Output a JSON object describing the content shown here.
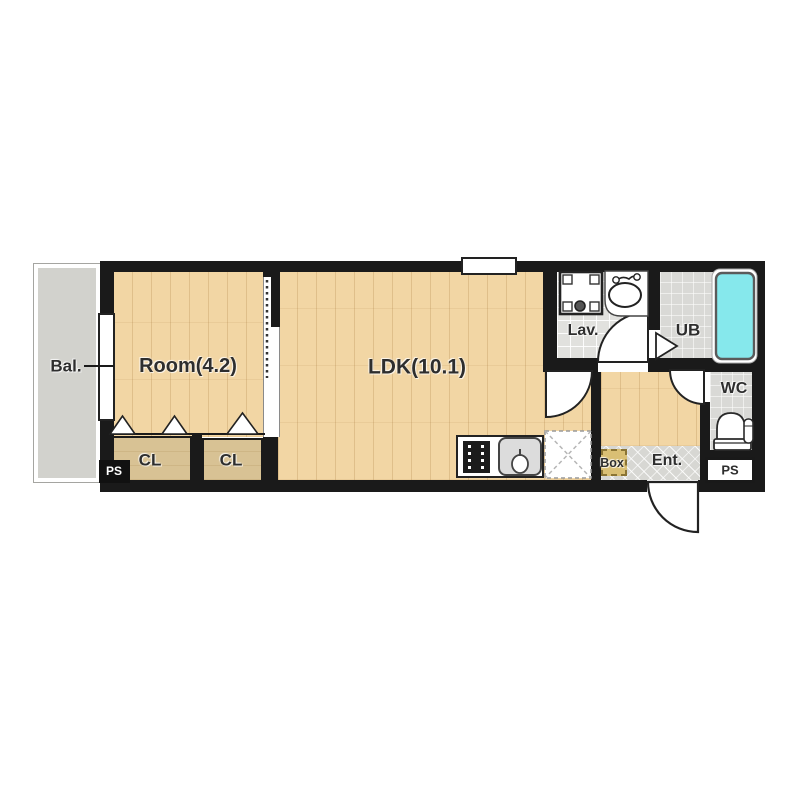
{
  "image_type": "apartment floor plan",
  "rooms": {
    "balcony": {
      "label": "Bal."
    },
    "bedroom": {
      "label": "Room(4.2)"
    },
    "ldk": {
      "label": "LDK(10.1)"
    },
    "lavatory": {
      "label": "Lav."
    },
    "unit_bath": {
      "label": "UB"
    },
    "toilet_room": {
      "label": "WC"
    },
    "closet_left": {
      "label": "CL"
    },
    "closet_right": {
      "label": "CL"
    },
    "entrance": {
      "label": "Ent."
    },
    "shoe_box": {
      "label": "Box"
    },
    "pipe_shaft_left": {
      "label": "PS"
    },
    "pipe_shaft_right": {
      "label": "PS"
    }
  },
  "fixtures": [
    "washing-machine-pan",
    "lavatory-sink",
    "bathtub",
    "toilet",
    "gas-stove",
    "kitchen-sink",
    "refrigerator-space",
    "sliding-door",
    "hinged-door-swings",
    "closet-folding-doors",
    "unit-bath-step"
  ],
  "colors": {
    "wall": "#1a1a1a",
    "wood_floor": "#f2d6a4",
    "closet_floor": "#d8c294",
    "balcony_floor": "#d2d2cd",
    "wet_area_floor": "#e1e1de",
    "entrance_tile": "#d7d7d3",
    "bathtub": "#86e8ec",
    "shoe_box": "#d9bf74",
    "background": "#ffffff"
  }
}
